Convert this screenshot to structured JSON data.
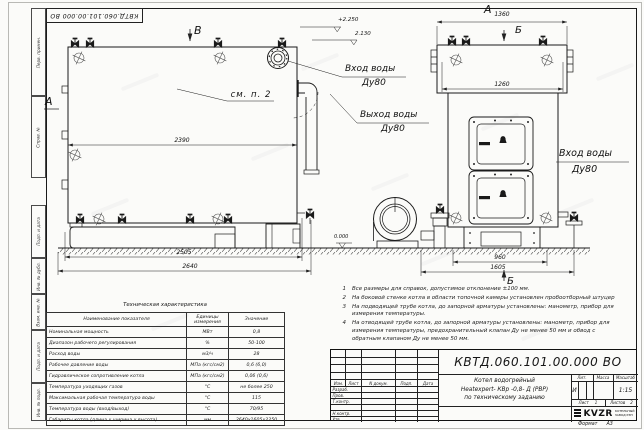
{
  "stamp": {
    "doc_number": "КВТД.060.101.00.000 ВО"
  },
  "margin_labels": [
    "Перв. примен.",
    "Справ. №",
    "Подп. и дата",
    "Инв. № дубл.",
    "Взам. инв. №",
    "Подп. и дата",
    "Инв. № подл."
  ],
  "front_view": {
    "view_top": "В",
    "view_left": "А",
    "callout": "см. п. 2",
    "elev_top": "+2.250",
    "elev_mid": "2.130",
    "elev_zero": "0.000",
    "dim_top": "2390",
    "dim_base": "2505",
    "dim_overall": "2640",
    "inlet_line1": "Вход воды",
    "inlet_line2": "Ду80",
    "outlet_line1": "Выход воды",
    "outlet_line2": "Ду80"
  },
  "side_view": {
    "view_top": "А",
    "section_top": "Б",
    "section_bottom": "Б",
    "dim_top": "1360",
    "dim_inner": "1260",
    "dim_base": "960",
    "dim_overall": "1605",
    "inlet_line1": "Вход воды",
    "inlet_line2": "Ду80"
  },
  "notes": {
    "items": [
      {
        "num": "1",
        "text": "Все размеры для справок, допустимое отклонение ±100 мм."
      },
      {
        "num": "2",
        "text": "На боковой стенке котла в области топочной камеры установлен пробоотборный штуцер"
      },
      {
        "num": "3",
        "text": "На подводящей трубе котла, до запорной арматуры установлены: манометр, прибор для измерения температуры."
      },
      {
        "num": "4",
        "text": "На отводящей трубе котла, до запорной арматуры установлены: манометр, прибор для измерения температуры, предохранительный клапан Ду не менее 50 мм и обвод с обратным клапаном Ду не менее 50 мм."
      }
    ]
  },
  "spec_table": {
    "title": "Техническая характеристика",
    "col1": "Наименование показателя",
    "col2": "Единицы измерения",
    "col3": "Значение",
    "rows": [
      {
        "name": "Номинальная мощность",
        "unit": "МВт",
        "value": "0,8"
      },
      {
        "name": "Диапазон рабочего регулирования",
        "unit": "%",
        "value": "50-100"
      },
      {
        "name": "Расход воды",
        "unit": "м3/ч",
        "value": "28"
      },
      {
        "name": "Рабочее давление воды",
        "unit": "МПа (кгс/см2)",
        "value": "0,6 (6,0)"
      },
      {
        "name": "Гидравлическое сопротивление котла",
        "unit": "МПа (кгс/см2)",
        "value": "0,06 (0,6)"
      },
      {
        "name": "Температура уходящих газов",
        "unit": "°С",
        "value": "не более 250"
      },
      {
        "name": "Максимальная рабочая температура воды",
        "unit": "°С",
        "value": "115"
      },
      {
        "name": "Температура воды (вход/выход)",
        "unit": "°С",
        "value": "70/95"
      },
      {
        "name": "Габариты котла (длина х ширина х высота)",
        "unit": "мм",
        "value": "2640х1605х2250"
      }
    ]
  },
  "title_block": {
    "doc_number": "КВТД.060.101.00.000  ВО",
    "title_line1": "Котел водогрейный",
    "title_line2": "Heatexpert- КВр -0,8- Д (РВР)",
    "title_line3": "по техническому заданию",
    "rev_cols": [
      "Изм.",
      "Лист",
      "N докум.",
      "Подп.",
      "Дата"
    ],
    "sig_labels": [
      "Разраб.",
      "Пров.",
      "Т.контр.",
      "Н.контр.",
      "Утв."
    ],
    "lit_label": "Лит.",
    "lit_value": "И",
    "mass_label": "Масса",
    "scale_label": "Масштаб",
    "scale_value": "1:15",
    "sheet_label": "Лист",
    "sheet_value": "1",
    "sheets_label": "Листов",
    "sheets_value": "2",
    "company_name": "KVZR",
    "company_line1": "КОТЕЛЬНЫЙ",
    "company_line2": "ЗАВОД РЭП",
    "format_label": "Формат",
    "format_value": "А3"
  }
}
